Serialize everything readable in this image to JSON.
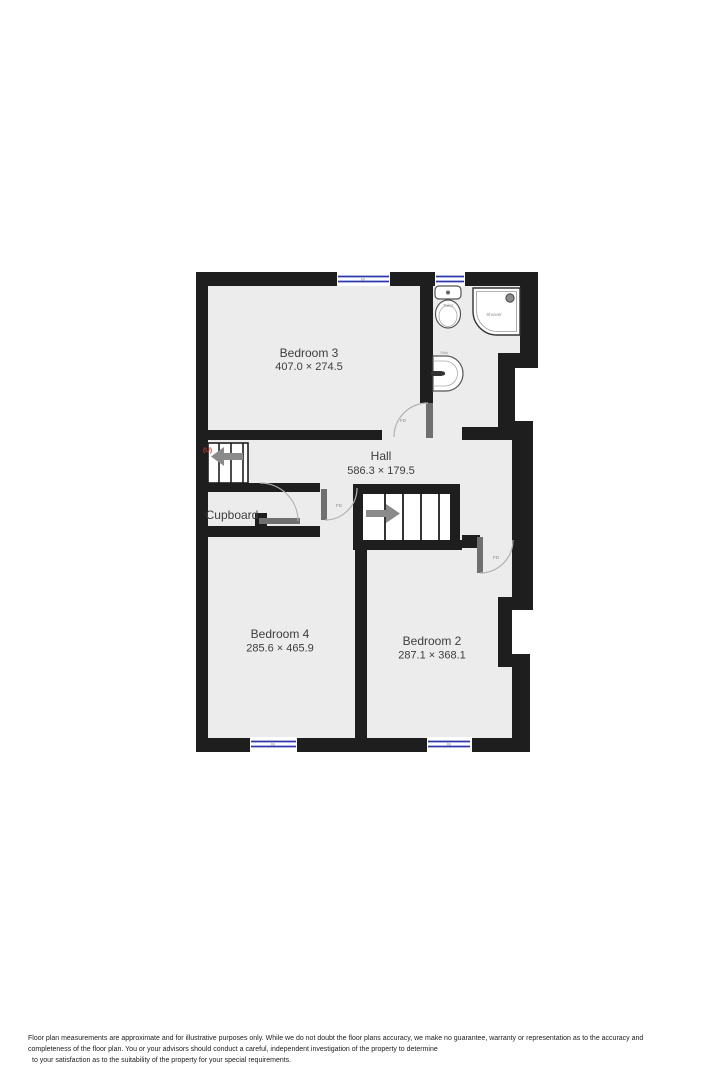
{
  "plan": {
    "rooms": [
      {
        "id": "bedroom3",
        "name": "Bedroom 3",
        "dims": "407.0 × 274.5"
      },
      {
        "id": "hall",
        "name": "Hall",
        "dims": "586.3 × 179.5"
      },
      {
        "id": "cupboard",
        "name": "Cupboard",
        "dims": ""
      },
      {
        "id": "bedroom4",
        "name": "Bedroom 4",
        "dims": "285.6 × 465.9"
      },
      {
        "id": "bedroom2",
        "name": "Bedroom 2",
        "dims": "287.1 × 368.1"
      }
    ],
    "fixtures": [
      {
        "id": "toilet",
        "label": "Toilet"
      },
      {
        "id": "shower",
        "label": "Shower"
      },
      {
        "id": "sink",
        "label": "Sink"
      }
    ],
    "fire_door_label": "FD",
    "stairs_up_label": "(U)",
    "window_label": "W"
  },
  "colors": {
    "wall": "#1e1e1e",
    "floor": "#ececec",
    "window_blue": "#2e36ae",
    "door_gray": "#6f6f6f",
    "label_gray": "#3d3d3d",
    "stair_arrow": "#8a8a8a",
    "up_red": "#c0392b"
  },
  "footer": {
    "line1": "Floor plan measurements are approximate and for illustrative purposes only. While we do not doubt the floor plans accuracy, we make no guarantee, warranty or representation as to the accuracy and",
    "line2": "completeness of the floor plan. You or your advisors should conduct a careful, independent investigation of the property to determine",
    "line3": "to your satisfaction as to the suitability of the property for your special requirements."
  }
}
